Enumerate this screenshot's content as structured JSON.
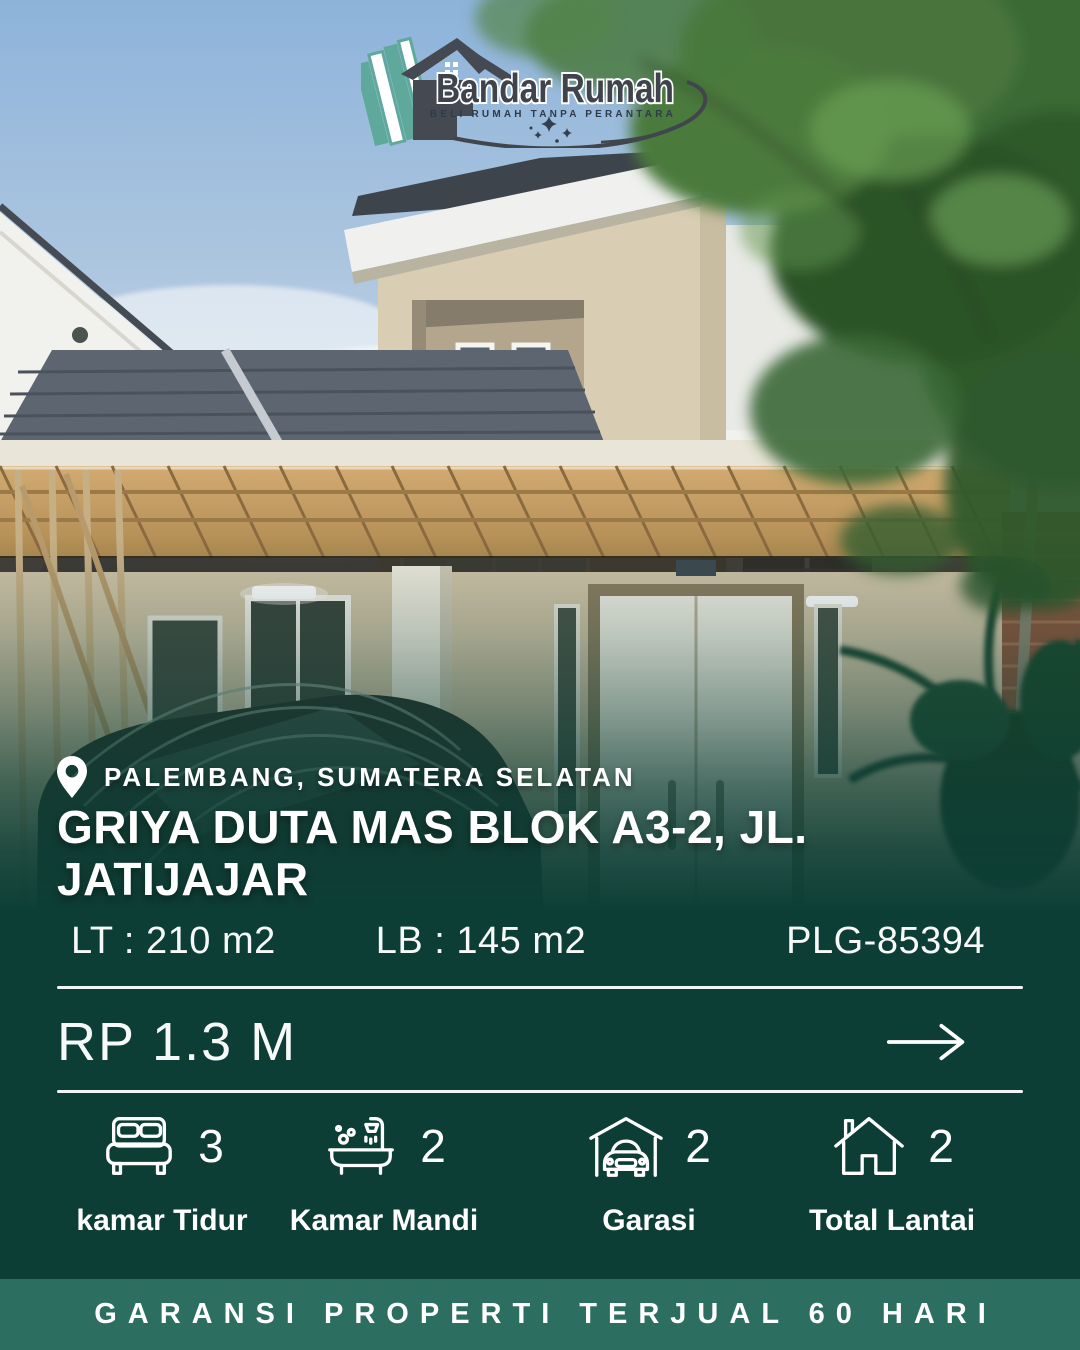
{
  "logo": {
    "brand": "Bandar Rumah",
    "tagline": "BELI RUMAH TANPA PERANTARA"
  },
  "listing": {
    "location": "PALEMBANG, SUMATERA SELATAN",
    "title": "GRIYA DUTA MAS BLOK A3-2, JL. JATIJAJAR",
    "land_area_label": "LT : 210 m2",
    "building_area_label": "LB : 145 m2",
    "listing_code": "PLG-85394",
    "price": "RP 1.3 M"
  },
  "features": [
    {
      "icon": "bed-icon",
      "count": "3",
      "label": "kamar Tidur"
    },
    {
      "icon": "bath-icon",
      "count": "2",
      "label": "Kamar Mandi"
    },
    {
      "icon": "garage-icon",
      "count": "2",
      "label": "Garasi"
    },
    {
      "icon": "floors-icon",
      "count": "2",
      "label": "Total Lantai"
    }
  ],
  "footer": {
    "banner": "GARANSI PROPERTI TERJUAL 60 HARI"
  },
  "colors": {
    "overlay_green": "#0d3e35",
    "banner_green": "#2c6e60",
    "logo_teal": "#5fa99c",
    "logo_gray": "#3f444c"
  }
}
